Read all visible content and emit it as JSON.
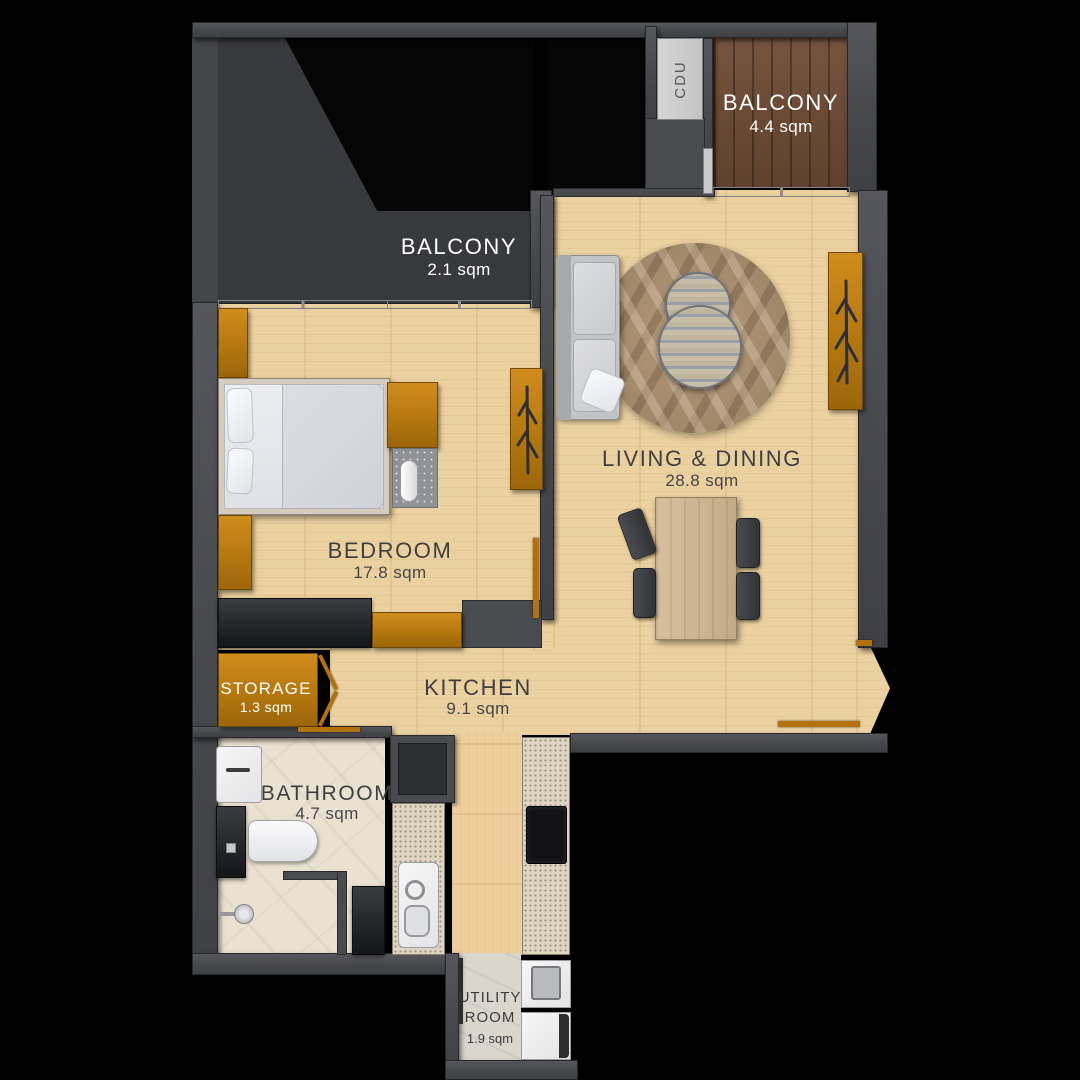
{
  "floor_plan": {
    "rooms": {
      "balcony_upper": {
        "name": "BALCONY",
        "area": "4.4 sqm"
      },
      "balcony_lower": {
        "name": "BALCONY",
        "area": "2.1 sqm"
      },
      "living_dining": {
        "name": "LIVING & DINING",
        "area": "28.8 sqm"
      },
      "bedroom": {
        "name": "BEDROOM",
        "area": "17.8 sqm"
      },
      "storage": {
        "name": "STORAGE",
        "area": "1.3 sqm"
      },
      "kitchen": {
        "name": "KITCHEN",
        "area": "9.1 sqm"
      },
      "bathroom": {
        "name": "BATHROOM",
        "area": "4.7 sqm"
      },
      "utility": {
        "name": "UTILITY ROOM",
        "area": "1.9 sqm"
      }
    },
    "labels": {
      "cdu": "CDU"
    },
    "colors": {
      "background": "#000000",
      "wall": "#4a4b4f",
      "wood_floor": "#ecd1a0",
      "balcony_wood": "#6d4a32",
      "bathroom_tile": "#e9e2d1",
      "counter": "#ded6c2",
      "cabinet_orange": "#c9841a",
      "door_accent": "#b3720e",
      "label_dark": "#3e3f41",
      "label_light": "#ffffff"
    }
  }
}
